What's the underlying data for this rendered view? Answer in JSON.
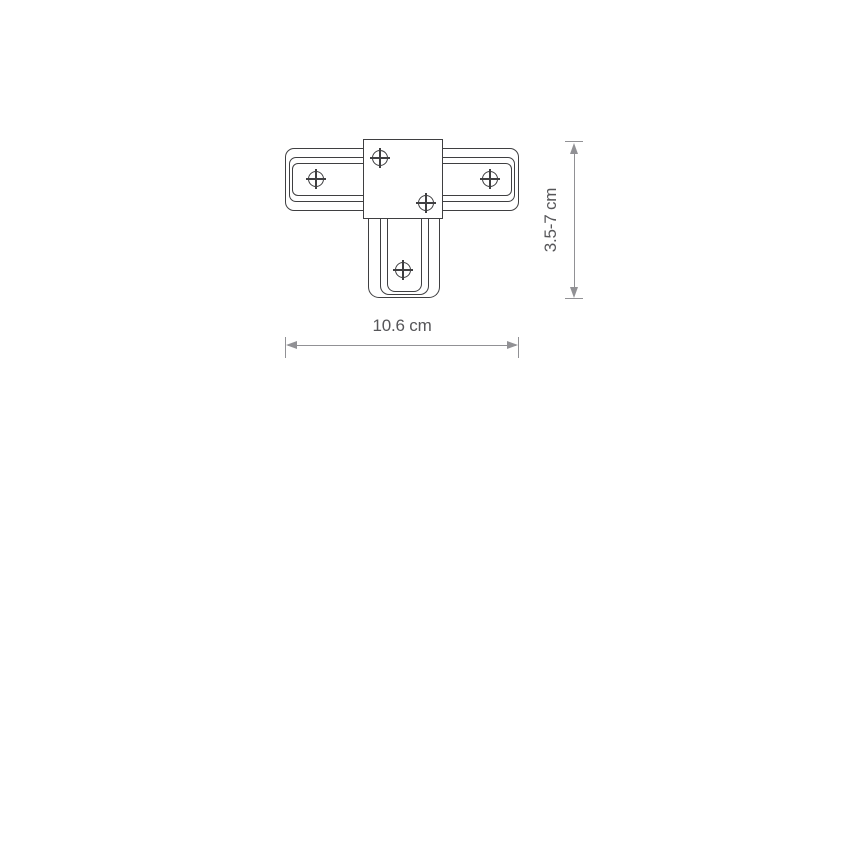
{
  "diagram": {
    "type": "technical-dimension-drawing",
    "subject": "T-shaped track connector, top view",
    "screw_count": 5,
    "width_dimension": {
      "label": "10.6 cm"
    },
    "height_dimension": {
      "label": "3.5-7 cm"
    },
    "colors": {
      "outline": "#3f3f41",
      "dimension_line": "#919195",
      "dimension_text": "#565659",
      "background": "#ffffff"
    }
  }
}
